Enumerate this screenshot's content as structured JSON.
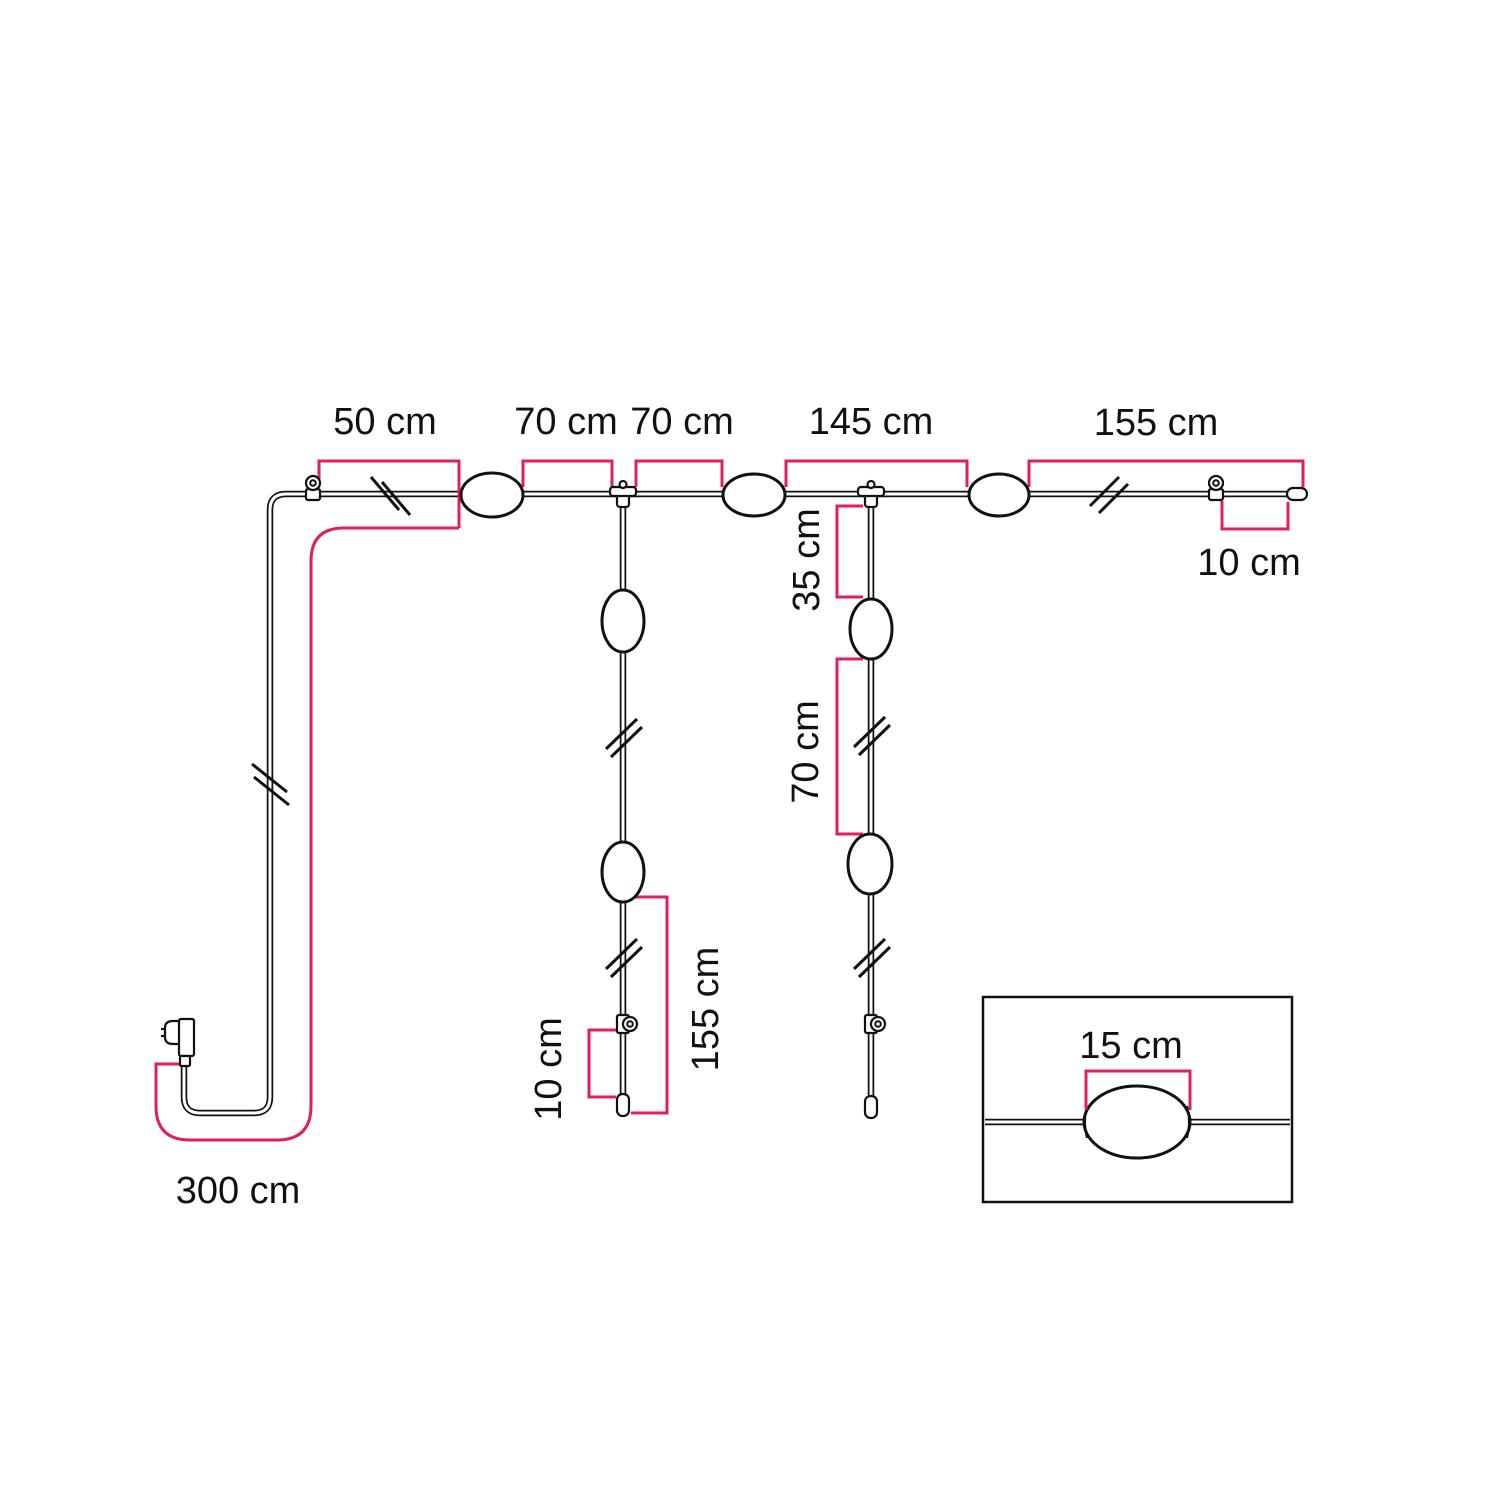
{
  "diagram": {
    "description": "Dimensional drawing of a plug-in string light with a main horizontal run, three lamp drops, wall hooks, a power plug and a lamp-width detail inset",
    "units": "cm",
    "colors": {
      "dimension_lines": "#e01e63",
      "artwork_lines": "#111111",
      "background": "#ffffff"
    },
    "labels": {
      "top_span_50": "50 cm",
      "top_span_70_a": "70 cm",
      "top_span_70_b": "70 cm",
      "top_span_145": "145 cm",
      "top_span_155": "155 cm",
      "top_end_offset_10": "10 cm",
      "supply_cord_300": "300 cm",
      "drop1_length_155": "155 cm",
      "drop1_end_offset_10": "10 cm",
      "drop2_upper_35": "35 cm",
      "drop2_lower_70": "70 cm",
      "inset_lamp_width_15": "15 cm"
    }
  }
}
